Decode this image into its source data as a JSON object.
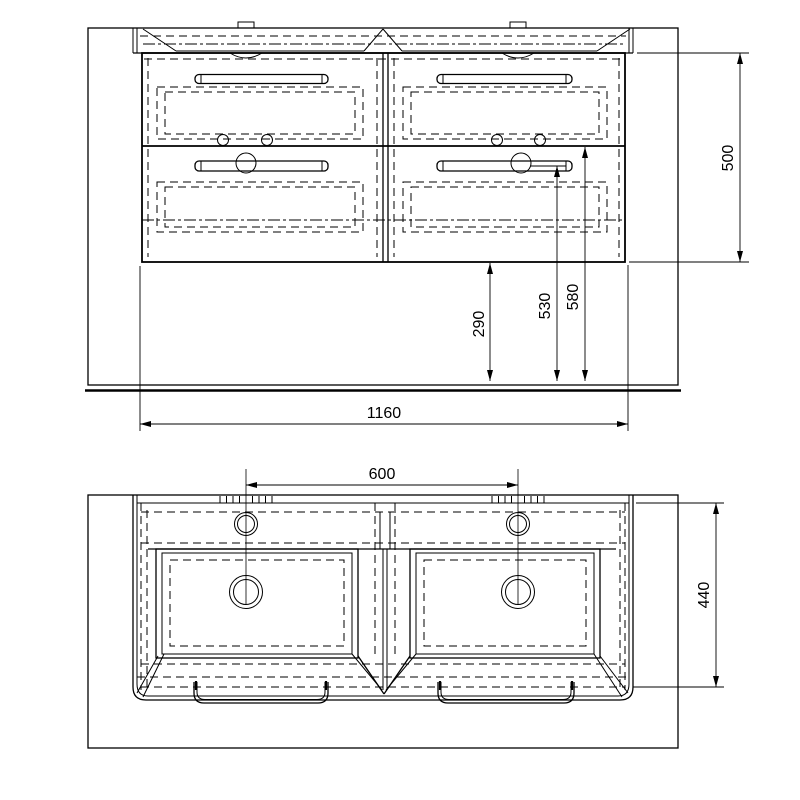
{
  "canvas": {
    "background_color": "#ffffff",
    "line_color": "#000000"
  },
  "views": {
    "front": {
      "dims": {
        "cabinet_height_mm": "500",
        "floor_clearance_mm": "290",
        "drain_height_mm": "530",
        "supply_height_mm": "580",
        "cabinet_width_mm": "1160"
      }
    },
    "top": {
      "dims": {
        "faucet_spacing_mm": "600",
        "depth_mm": "440"
      }
    }
  }
}
